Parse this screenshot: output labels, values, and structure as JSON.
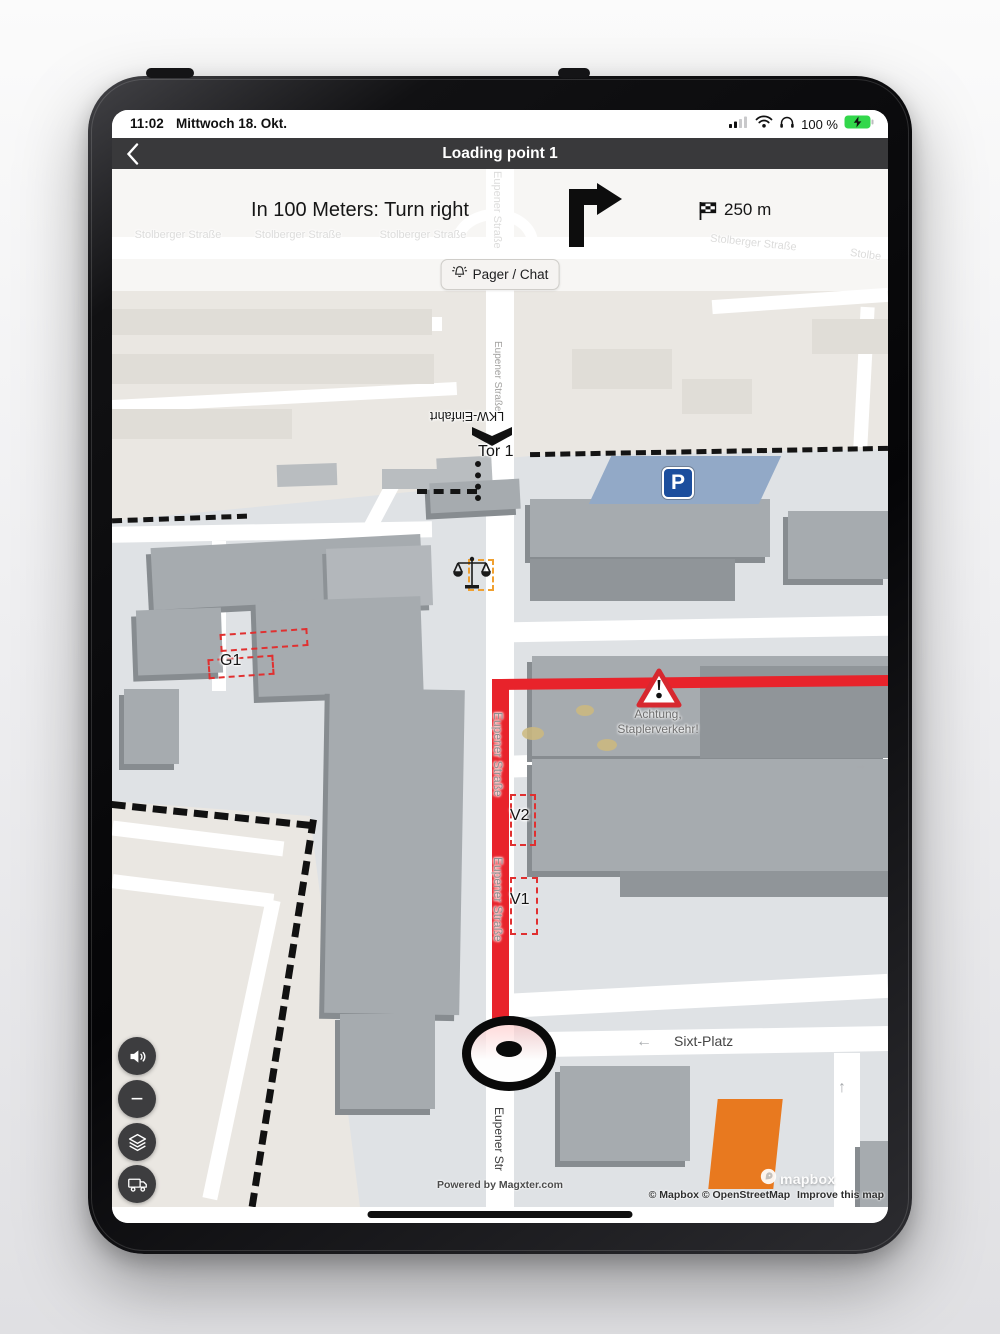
{
  "status_bar": {
    "time": "11:02",
    "date": "Mittwoch 18. Okt.",
    "battery_percent": "100 %"
  },
  "header": {
    "title": "Loading point 1"
  },
  "instruction_panel": {
    "instruction": "In 100 Meters: Turn right",
    "distance": "250 m",
    "pager_chat_label": "Pager / Chat"
  },
  "map": {
    "street_labels": {
      "stolberger": "Stolberger Straße",
      "stolberger_cut": "Stolbe",
      "eupener": "Eupener Straße",
      "eupener_cut": "Eupener Str",
      "sixt": "Sixt-Platz"
    },
    "poi_labels": {
      "lkw_einfahrt": "LKW-Einfahrt",
      "tor": "Tor 1",
      "parking": "P",
      "g1": "G1",
      "v2": "V2",
      "v1": "V1",
      "warning_line1": "Achtung,",
      "warning_line2": "Staplerverkehr!"
    },
    "arrows": {
      "left": "←",
      "up": "↑",
      "right": "→"
    },
    "colors": {
      "route_red": "#e8232b",
      "warning_red": "#d7282f",
      "parking_sign_blue": "#1c4e9d",
      "parking_area_blue": "#92a9c7",
      "orange_building": "#e8791f",
      "campus_bg": "#dfe2e5",
      "outside_bg": "#eae7e2",
      "building_gray": "#a6abaf",
      "header_bg": "#39393b"
    }
  },
  "controls": {
    "zoom_out_label": "−"
  },
  "footer": {
    "powered_by": "Powered by Magxter.com",
    "mapbox_wordmark": "mapbox",
    "copyright": "© Mapbox © OpenStreetMap",
    "improve": "Improve this map"
  }
}
